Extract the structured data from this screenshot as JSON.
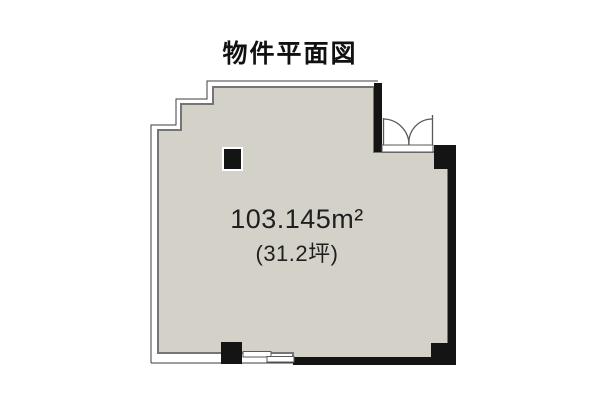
{
  "title": "物件平面図",
  "floor_plan": {
    "area_label": "103.145m²",
    "tsubo_label": "(31.2坪)",
    "fill_color": "#d4d1c9",
    "wall_color": "#141414",
    "text_color": "#1f1f1f",
    "symbols": {
      "door": "double-swing-door",
      "window": "sliding-window",
      "pillar": "structural-pillar"
    }
  }
}
